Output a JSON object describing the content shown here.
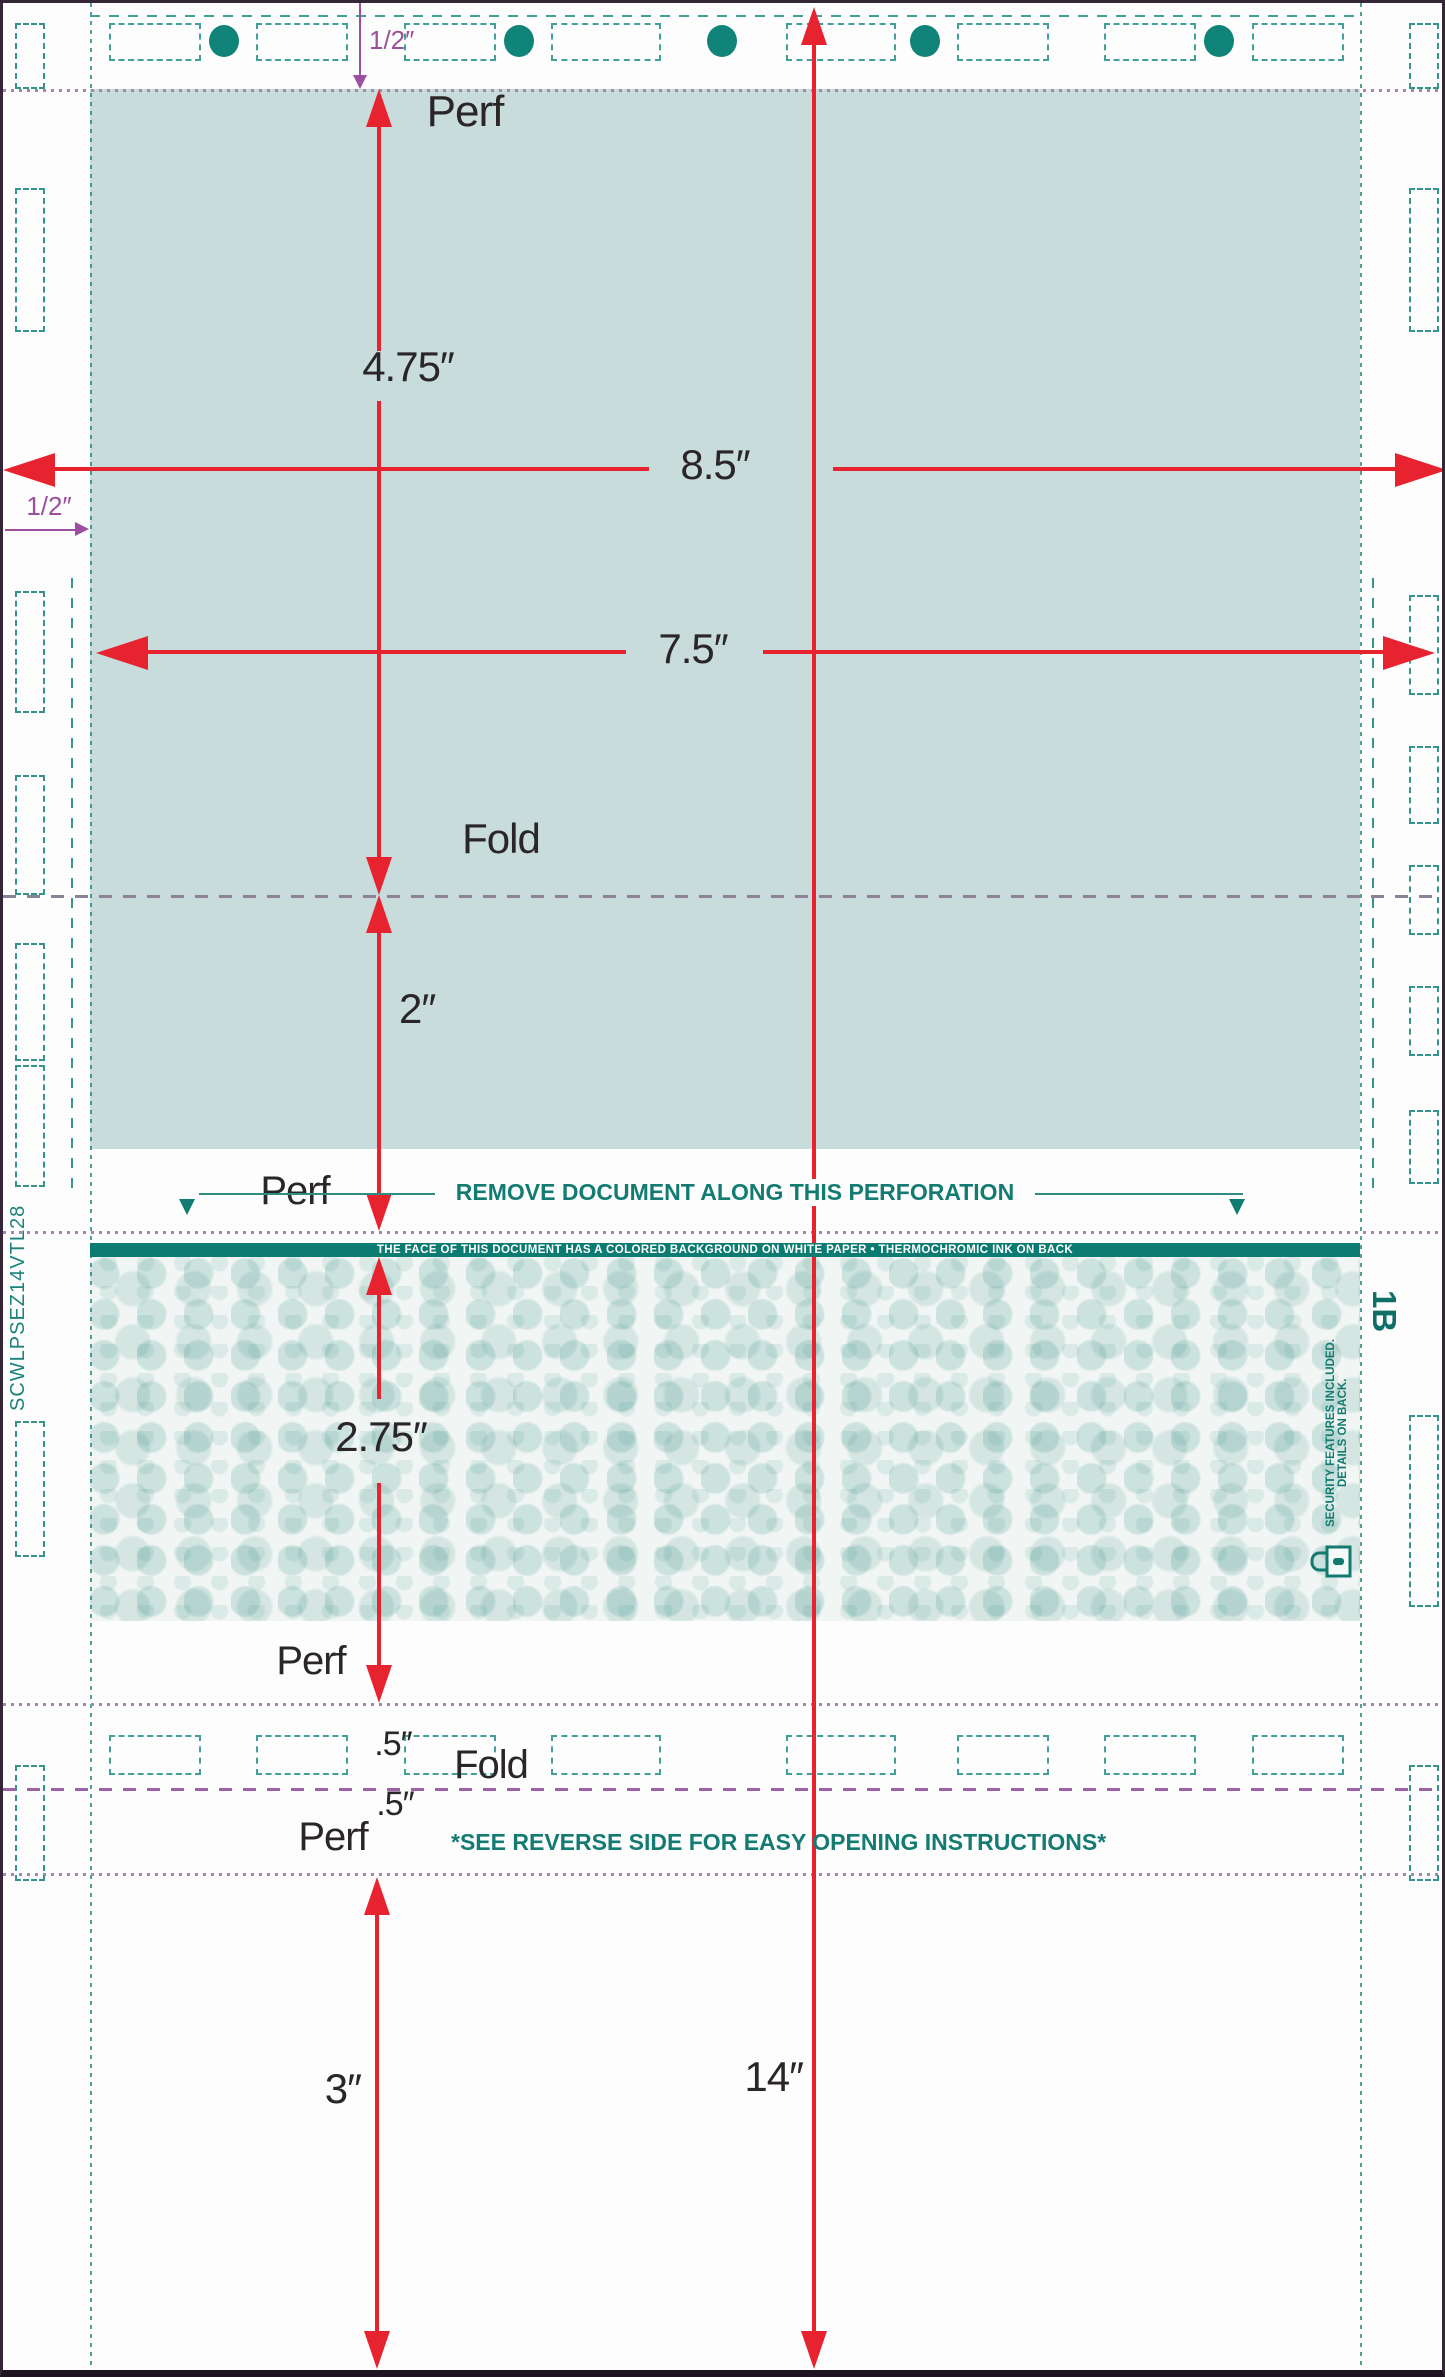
{
  "title": "Pressure-seal form layout diagram",
  "labels": {
    "top_margin": "1/2″",
    "left_margin": "1/2″",
    "perf_top": "Perf",
    "dim_4_75": "4.75″",
    "dim_8_5": "8.5″",
    "dim_7_5": "7.5″",
    "fold_top": "Fold",
    "dim_2": "2″",
    "perf_mid": "Perf",
    "dim_2_75": "2.75″",
    "perf_lower": "Perf",
    "dim_half_upper": ".5″",
    "fold_lower": "Fold",
    "dim_half_lower": ".5″",
    "perf_bottom": "Perf",
    "dim_3": "3″",
    "dim_14": "14″"
  },
  "banners": {
    "remove_document": "REMOVE DOCUMENT ALONG THIS PERFORATION",
    "face_notice": "THE FACE OF THIS DOCUMENT HAS A COLORED BACKGROUND ON WHITE PAPER • THERMOCHROMIC INK ON BACK",
    "see_reverse": "*SEE REVERSE SIDE FOR EASY OPENING INSTRUCTIONS*",
    "security_note": "SECURITY FEATURES INCLUDED. DETAILS ON BACK."
  },
  "codes": {
    "left_vertical": "SCWLPSEZ14VTL28",
    "right_vertical": "1B"
  },
  "colors": {
    "dimension_red": "#e82330",
    "margin_purple": "#9b4f9e",
    "teal_panel": "#c8dcdc",
    "teal_bar": "#0c7b72",
    "teal_text": "#137b72",
    "mark_teal": "#2f948c",
    "feed_hole": "#11847a"
  }
}
